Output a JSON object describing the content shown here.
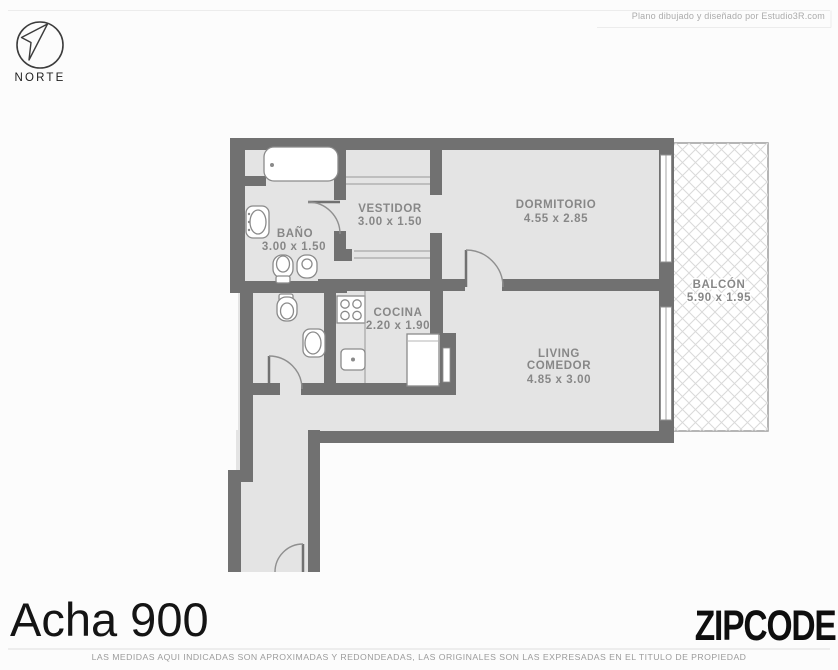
{
  "page": {
    "credit": "Plano dibujado y diseñado por Estudio3R.com",
    "title": "Acha 900",
    "brand": "ZIPCODE",
    "disclaimer": "LAS MEDIDAS AQUI INDICADAS SON APROXIMADAS Y REDONDEADAS, LAS ORIGINALES SON LAS EXPRESADAS EN EL TITULO DE PROPIEDAD"
  },
  "compass": {
    "label": "NORTE"
  },
  "plan": {
    "rooms": [
      {
        "name": "BAÑO",
        "dims": "3.00 x 1.50"
      },
      {
        "name": "VESTIDOR",
        "dims": "3.00 x 1.50"
      },
      {
        "name": "DORMITORIO",
        "dims": "4.55 x 2.85"
      },
      {
        "name": "COCINA",
        "dims": "2.20 x 1.90"
      },
      {
        "name": "LIVING",
        "name_line2": "COMEDOR",
        "dims": "4.85 x 3.00"
      },
      {
        "name": "BALCÓN",
        "dims": "5.90 x 1.95"
      }
    ]
  },
  "colors": {
    "wall": "#717171",
    "floor": "#e4e4e4",
    "label": "#878787",
    "fixture_stroke": "#8a8a8a",
    "balcony_hatch": "#d9d9d9",
    "title_text": "#141414"
  }
}
